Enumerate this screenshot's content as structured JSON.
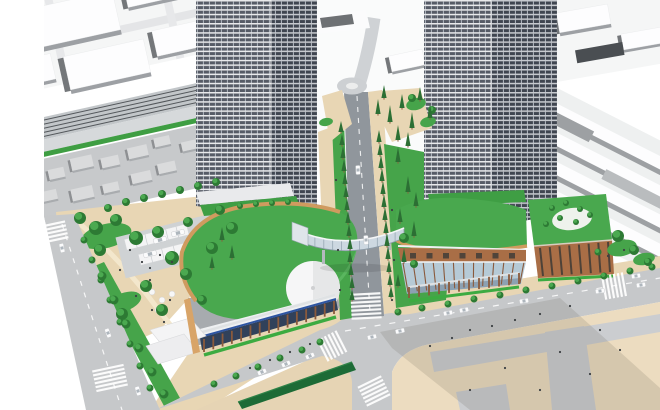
{
  "scene": {
    "type": "architectural-aerial-rendering",
    "title": "Station-front redevelopment bird's-eye rendering",
    "description": "Computer-generated aerial rendering of a station-front redevelopment: two high-rise residential towers rise from curved green-roofed retail podiums linked by a glass pedestrian skybridge over a tree-lined boulevard; railway tracks, station platforms and white low-rise city massing fill the background, with a bus terminal, landscaped park, plaza with crosswalks, cars and pedestrians at street level."
  },
  "elements": [
    "left high-rise tower",
    "right high-rise tower",
    "left green-roof podium with white tent canopy",
    "right green-roof podium with brick and glass facade",
    "glass pedestrian skybridge",
    "tree-lined central boulevard",
    "railway tracks",
    "station platforms",
    "bus terminal canopies",
    "landscaped park",
    "paved plaza with shadow",
    "crosswalk intersections",
    "street trees",
    "cars",
    "pedestrians"
  ],
  "colors": {
    "background": "#ffffff",
    "massing_ground": "#f5f6f6",
    "massing_top": "#fdfdfe",
    "massing_side": "#74777a",
    "massing_side_soft": "#9da0a4",
    "rail_bed": "#c2c6c9",
    "rail_line": "#53575b",
    "service_road": "#d6d9db",
    "residential_ground": "#c7c9cb",
    "house_top": "#dadbdc",
    "house_side": "#8e9093",
    "tower_slab": "#e9eaec",
    "tower_window": "#565b66",
    "tower_slab_shade": "#c7cacf",
    "tower_window_shade": "#3f4550",
    "green_roof": "#49a84e",
    "green_roof_light": "#5db963",
    "lawn": "#46a44a",
    "hedge": "#3cab41",
    "tree_dark": "#2d7a34",
    "tree_light": "#4fae53",
    "conifer": "#2c6f34",
    "wood_rim": "#cf9b5f",
    "wood_column": "#8a5a3c",
    "brick": "#a96e46",
    "brick_dark": "#4e4238",
    "street": "#c6c8ca",
    "asphalt": "#90969c",
    "sidewalk": "#e8d6b4",
    "plaza": "#ecdcc0",
    "plaza_gray": "#cbcdd0",
    "shadow": "#5a5244",
    "glass": "#b6cad6",
    "glass_deep": "#7d93a6",
    "bridge_glass": "#cdd8e1",
    "canopy_white": "#f4f4f5",
    "sign_blue": "#2e55a2",
    "bus_canopy": "#1d6b36",
    "car_body": "#fbfbfc",
    "people": "#3c4043",
    "station_shade": "#9da0a3",
    "station_ground": "#eef0f0"
  }
}
